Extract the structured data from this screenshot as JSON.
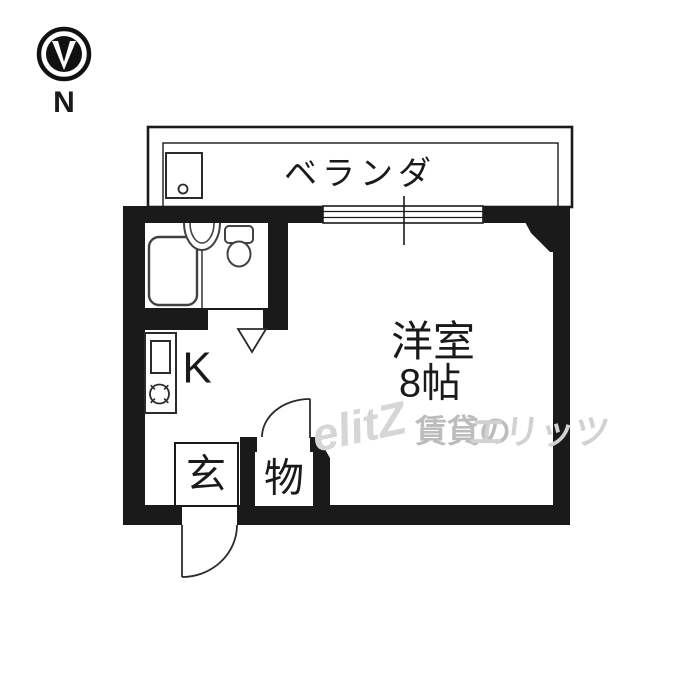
{
  "compass": {
    "label": "N"
  },
  "balcony": {
    "label": "ベランダ"
  },
  "rooms": {
    "main": {
      "name": "洋室",
      "size": "8帖"
    },
    "kitchen": {
      "label": "K"
    },
    "entrance": {
      "label": "玄"
    },
    "storage": {
      "label": "物"
    }
  },
  "fixtures": {
    "bathtub": "bathtub",
    "washbasin": "washbasin",
    "toilet": "toilet",
    "sink": "kitchen-sink",
    "stove": "stove-burner",
    "window": "sliding-window",
    "washing_pan": "balcony-utility-pan"
  },
  "watermark": {
    "logo": "elitZ",
    "brand_prefix": "賃貸の",
    "brand_name": "エリッツ"
  },
  "colors": {
    "wall": "#1a1a1a",
    "fixture_line": "#414141",
    "door_line": "#2b2b2b",
    "watermark_light": "#d6d6d6",
    "watermark_mid": "#bcbcbc"
  }
}
